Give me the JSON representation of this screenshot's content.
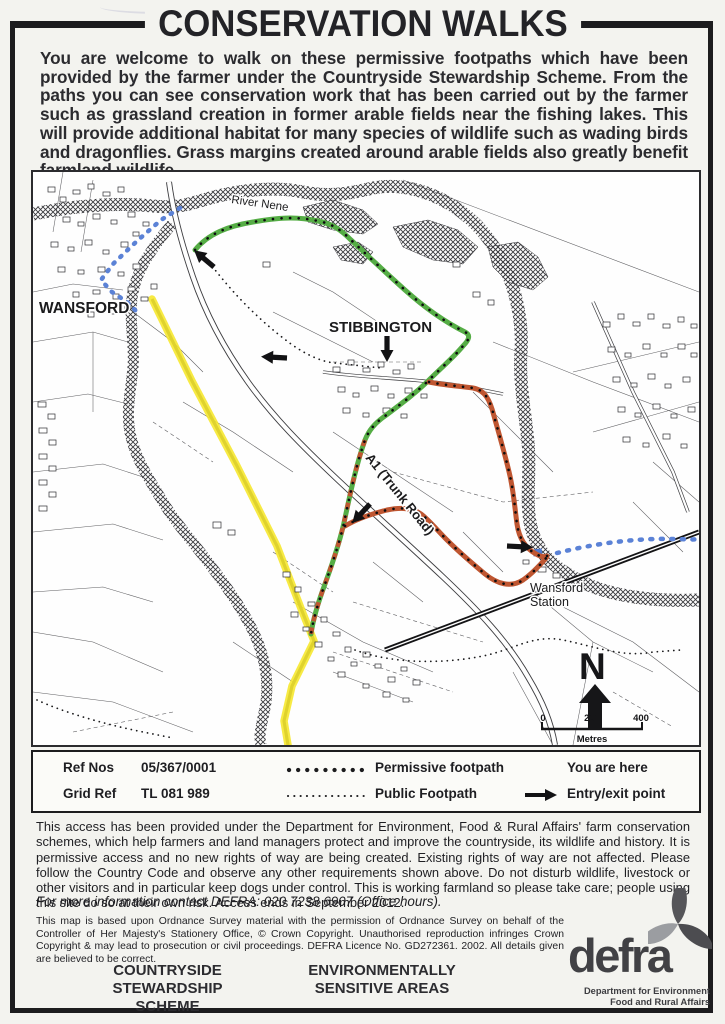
{
  "page": {
    "title": "CONSERVATION WALKS",
    "intro": "You are welcome to walk on these permissive footpaths which have been provided by the farmer under the Countryside Stewardship Scheme. From the paths you can see conservation work that has been carried out by the farmer such as grassland creation in former arable fields near the fishing lakes. This will provide additional habitat for many species of wildlife such as wading birds and dragonflies. Grass margins created around arable fields also greatly benefit farmland wildlife."
  },
  "map": {
    "labels": {
      "river": "River Nene",
      "wansford": "WANSFORD",
      "stibbington": "STIBBINGTON",
      "a1": "A1 (Trunk Road)",
      "station_line1": "Wansford",
      "station_line2": "Station",
      "north": "N",
      "scale_0": "0",
      "scale_200": "200",
      "scale_400": "400",
      "scale_unit": "Metres"
    }
  },
  "legend": {
    "ref_nos_label": "Ref Nos",
    "ref_nos_value": "05/367/0001",
    "grid_ref_label": "Grid Ref",
    "grid_ref_value": "TL 081 989",
    "permissive_label": "Permissive footpath",
    "public_label": "Public Footpath",
    "you_are_here_label": "You are here",
    "entry_exit_label": "Entry/exit point"
  },
  "access": {
    "body": "This access has been provided under the Department for Environment, Food & Rural Affairs' farm conservation schemes, which help farmers and land managers protect and improve the countryside, its wildlife and history. It is permissive access and no new rights of way are being created. Existing rights of way are not affected. Please follow the Country Code and observe any other requirements shown above. Do not disturb wildlife, livestock or other visitors and in particular keep dogs under control. This is working farmland so please take care; people using this site do so at their own risk.  Access ends in September 2012.",
    "contact": "For more information contact DEFRA: 020 7238 6907 (Office hours)."
  },
  "copyright": "This map is based upon Ordnance Survey material with the permission of Ordnance Survey on behalf of the Controller of Her Majesty's Stationery Office, © Crown Copyright. Unauthorised reproduction infringes Crown Copyright & may lead to prosecution or civil proceedings. DEFRA Licence No. GD272361. 2002. All details given are believed to be correct.",
  "footer": {
    "scheme1": "COUNTRYSIDE STEWARDSHIP SCHEME",
    "scheme2": "ENVIRONMENTALLY SENSITIVE AREAS",
    "defra_word": "defra",
    "defra_sub1": "Department for Environment",
    "defra_sub2": "Food and Rural Affairs"
  },
  "colors": {
    "permissive_green": "#55ad45",
    "permissive_red": "#bf5631",
    "road_yellow": "#f6e72a",
    "route_blue": "#5b82d6",
    "ink": "#1c1c1e"
  }
}
